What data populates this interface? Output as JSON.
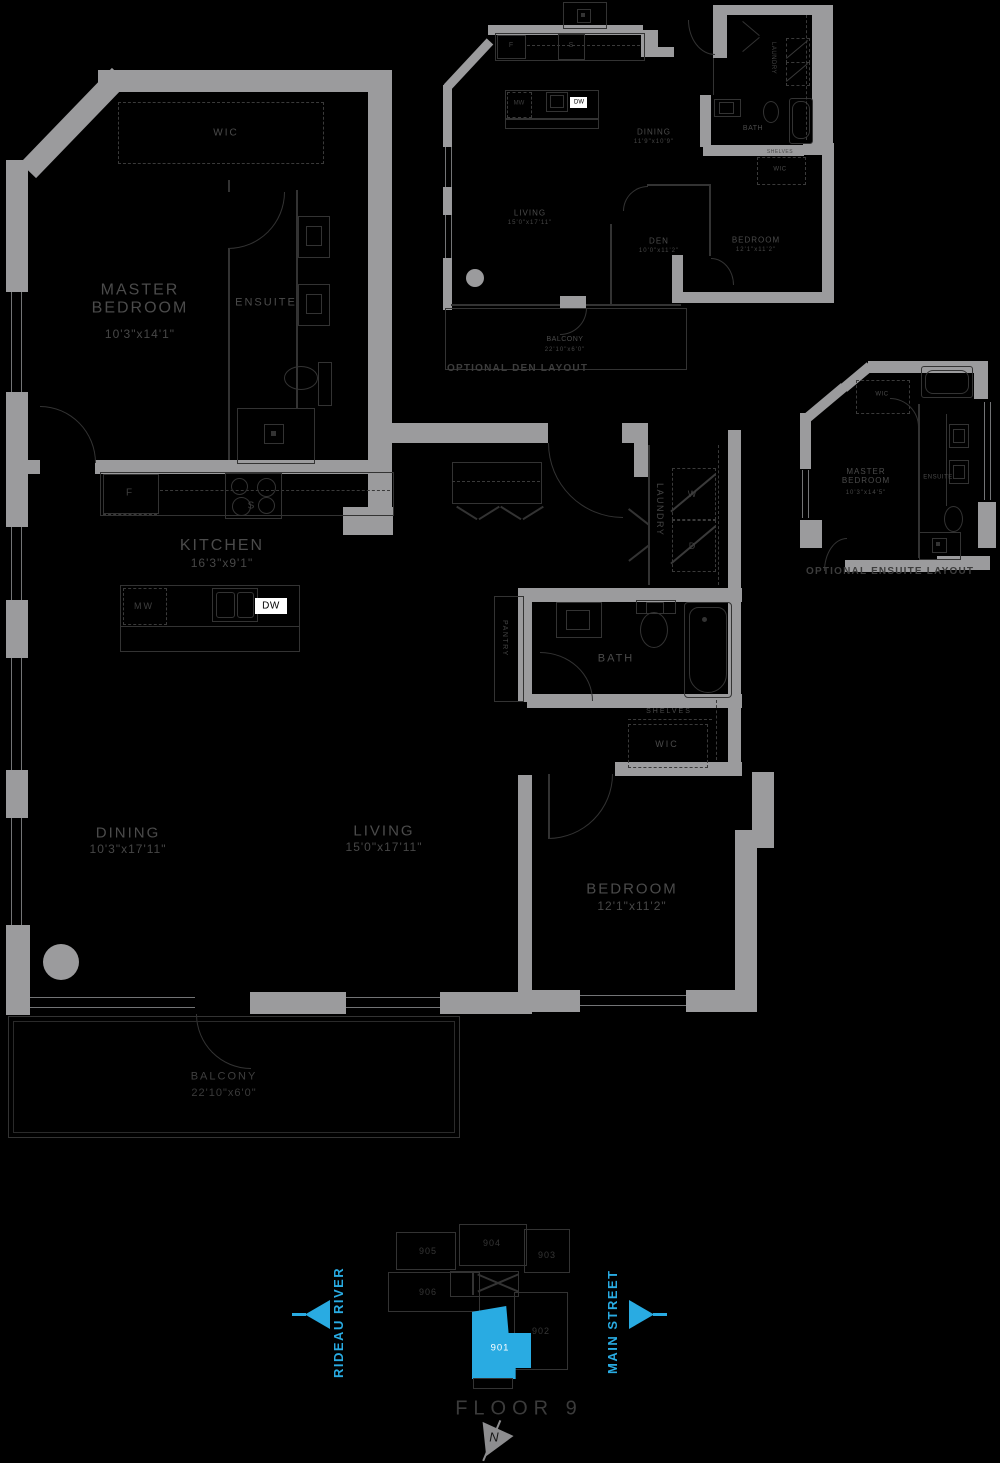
{
  "palette": {
    "background": "#000000",
    "wall": "#9b9b9d",
    "line": "#333333",
    "room_label": "#4b4b4b",
    "caption": "#3d3d3d",
    "key_label": "#353535",
    "floor_label": "#3b3b3b",
    "north_gray": "#8d8d8f",
    "accent": "#29abe2",
    "highlight_text": "#ffffff"
  },
  "main": {
    "wic": {
      "label": "WIC"
    },
    "master_bedroom": {
      "label": "MASTER BEDROOM",
      "dim": "10'3\"x14'1\""
    },
    "ensuite": {
      "label": "ENSUITE"
    },
    "kitchen": {
      "label": "KITCHEN",
      "dim": "16'3\"x9'1\""
    },
    "dining": {
      "label": "DINING",
      "dim": "10'3\"x17'11\""
    },
    "living": {
      "label": "LIVING",
      "dim": "15'0\"x17'11\""
    },
    "bedroom": {
      "label": "BEDROOM",
      "dim": "12'1\"x11'2\""
    },
    "bath": {
      "label": "BATH"
    },
    "laundry": {
      "label": "LAUNDRY"
    },
    "pantry": {
      "label": "PANTRY"
    },
    "wic2": {
      "label": "WIC"
    },
    "shelves": {
      "label": "SHELVES"
    },
    "balcony": {
      "label": "BALCONY",
      "dim": "22'10\"x6'0\""
    },
    "appliances": {
      "fridge": "F",
      "stove": "S",
      "microwave": "MW",
      "dishwasher": "DW",
      "washer": "W",
      "dryer": "D"
    }
  },
  "optional_den": {
    "caption": "OPTIONAL DEN LAYOUT",
    "dining": {
      "label": "DINING",
      "dim": "11'9\"x10'9\""
    },
    "living": {
      "label": "LIVING",
      "dim": "15'0\"x17'11\""
    },
    "den": {
      "label": "DEN",
      "dim": "10'0\"x11'2\""
    },
    "bedroom": {
      "label": "BEDROOM",
      "dim": "12'1\"x11'2\""
    },
    "bath": {
      "label": "BATH"
    },
    "laundry": {
      "label": "LAUNDRY"
    },
    "wic": {
      "label": "WIC"
    },
    "shelves": {
      "label": "SHELVES"
    },
    "balcony": {
      "label": "BALCONY",
      "dim": "22'10\"x6'0\""
    },
    "appliances": {
      "fridge": "F",
      "stove": "S",
      "microwave": "MW",
      "dishwasher": "DW"
    }
  },
  "optional_ensuite": {
    "caption": "OPTIONAL ENSUITE LAYOUT",
    "master_bedroom": {
      "label": "MASTER BEDROOM",
      "dim": "10'3\"x14'5\""
    },
    "ensuite": {
      "label": "ENSUITE"
    },
    "wic": {
      "label": "WIC"
    }
  },
  "key_plan": {
    "floor_label": "FLOOR 9",
    "highlighted_unit": "901",
    "units": [
      {
        "id": "905"
      },
      {
        "id": "904"
      },
      {
        "id": "903"
      },
      {
        "id": "906"
      },
      {
        "id": "902"
      },
      {
        "id": "901"
      }
    ],
    "streets": {
      "left": "RIDEAU RIVER",
      "right": "MAIN STREET"
    },
    "north": {
      "label": "N"
    }
  }
}
